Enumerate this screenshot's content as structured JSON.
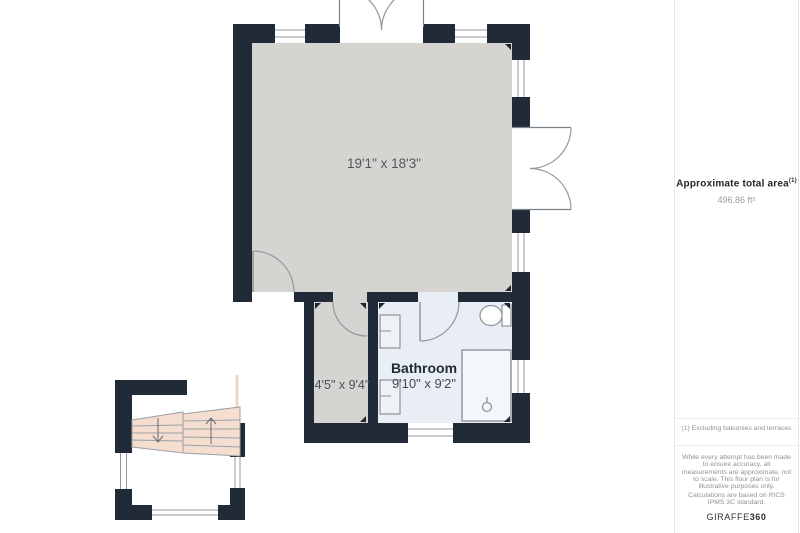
{
  "floor_plan": {
    "main_room": {
      "dimensions": "19'1\" x 18'3\""
    },
    "hallway": {
      "dimensions": "4'5\" x 9'4\""
    },
    "bathroom": {
      "name": "Bathroom",
      "dimensions": "9'10\" x 9'2\""
    }
  },
  "sidebar": {
    "area_label": "Approximate total area",
    "area_footnote_marker": "(1)",
    "area_value": "496.86 ft²",
    "footnote": "(1) Excluding balconies and terraces",
    "disclaimer_measurements": "While every attempt has been made to ensure accuracy, all measurements are approximate, not to scale. This floor plan is for illustrative purposes only.",
    "disclaimer_standard": "Calculations are based on RICS IPMS 3C standard.",
    "brand_name": "GIRAFFE",
    "brand_suffix": "360"
  },
  "colors": {
    "wall": "#212b38",
    "main_floor": "#d5d4d1",
    "bathroom_floor": "#e9eef5",
    "stairs_fill": "#f5ded0",
    "fixture_line": "#8d9298"
  }
}
